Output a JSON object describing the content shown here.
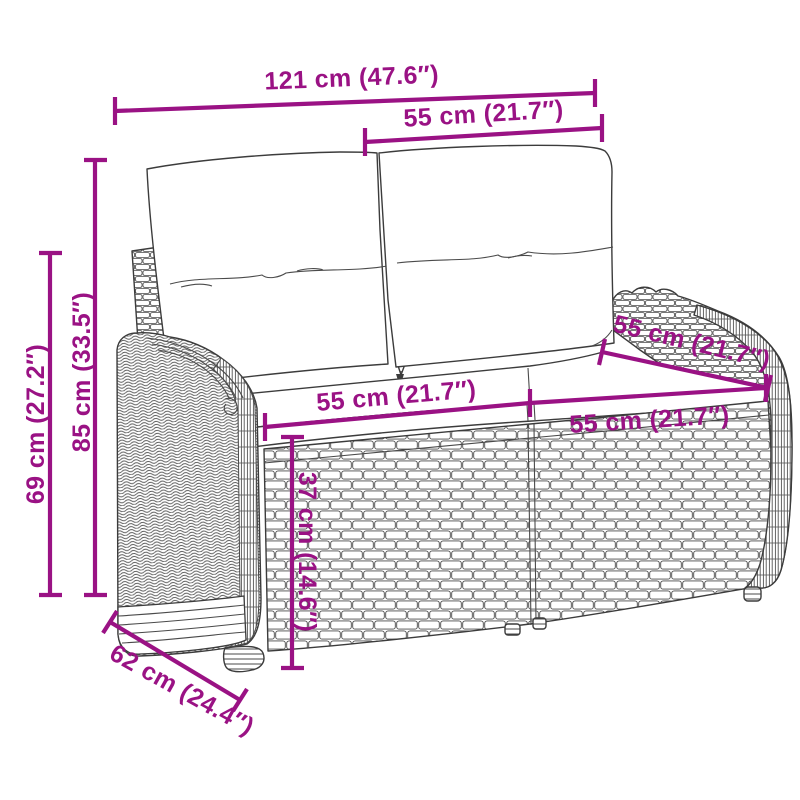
{
  "diagram": {
    "type": "product-dimension-diagram",
    "subject": "poly rattan 2-seater garden bench with back and seat cushions",
    "background_color": "#ffffff",
    "accent_color": "#9a1284",
    "line_art_color": "#3c3c3c"
  },
  "dimensions": [
    {
      "id": "overall-width",
      "label": "121 cm (47.6″)",
      "cm": 121,
      "inches": 47.6
    },
    {
      "id": "backrest-width",
      "label": "55 cm (21.7″)",
      "cm": 55,
      "inches": 21.7
    },
    {
      "id": "overall-height",
      "label": "85 cm (33.5″)",
      "cm": 85,
      "inches": 33.5
    },
    {
      "id": "armrest-height",
      "label": "69 cm (27.2″)",
      "cm": 69,
      "inches": 27.2
    },
    {
      "id": "seat-width-left",
      "label": "55 cm (21.7″)",
      "cm": 55,
      "inches": 21.7
    },
    {
      "id": "seat-width-right",
      "label": "55 cm (21.7″)",
      "cm": 55,
      "inches": 21.7
    },
    {
      "id": "seat-depth",
      "label": "55 cm (21.7″)",
      "cm": 55,
      "inches": 21.7
    },
    {
      "id": "seat-height",
      "label": "37 cm (14.6″)",
      "cm": 37,
      "inches": 14.6
    },
    {
      "id": "overall-depth",
      "label": "62 cm (24.4″)",
      "cm": 62,
      "inches": 24.4
    }
  ]
}
